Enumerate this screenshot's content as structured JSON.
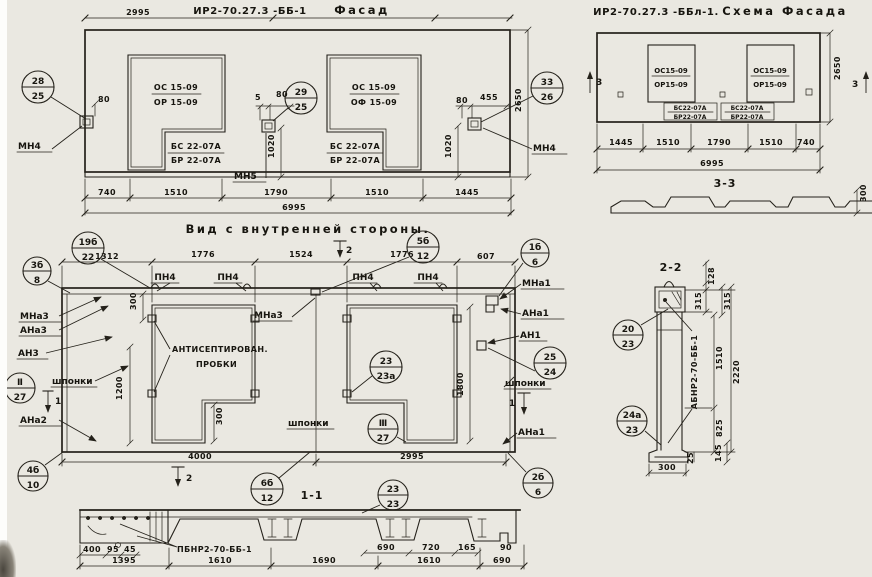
{
  "paper": {
    "bg": "#eae8e1",
    "ink": "#24211a"
  },
  "facade": {
    "dim_2995": "2995",
    "code": "ИР2-70.27.3 -ББ-1",
    "title": "Фасад",
    "win1_top": "ОС 15-09",
    "win1_bot": "ОР 15-09",
    "win2_top": "ОС 15-09",
    "win2_bot": "ОФ 15-09",
    "block1_top": "БС 22-07А",
    "block1_bot": "БР 22-07А",
    "block2_top": "БС 22-07А",
    "block2_bot": "БР 22-07А",
    "mn4_left": "МН4",
    "mn5": "МН5",
    "mn4_right": "МН4",
    "d80_left": "80",
    "d5": "5",
    "d80_mid": "80",
    "d80_right": "80",
    "d455": "455",
    "d1020_left": "1020",
    "d1020_right": "1020",
    "d2650": "2650",
    "dims_bottom": [
      "740",
      "1510",
      "1790",
      "1510",
      "1445"
    ],
    "d6995": "6995",
    "c28": {
      "top": "28",
      "bot": "25"
    },
    "c29": {
      "top": "29",
      "bot": "25"
    },
    "c33": {
      "top": "33",
      "bot": "26"
    }
  },
  "scheme": {
    "code": "ИР2-70.27.3 -ББл-1.",
    "title": "Схема Фасада",
    "win_top": "ОС15-09",
    "win_bot": "ОР15-09",
    "blk_top": "БС22-07А",
    "blk_bot": "БР22-07А",
    "marker3": "3",
    "d2650": "2650",
    "dims_bottom": [
      "1445",
      "1510",
      "1790",
      "1510",
      "740"
    ],
    "d6995": "6995",
    "sec33": "3-3",
    "d300": "300"
  },
  "inner": {
    "title": "Вид с внутренней стороны.",
    "dims_top": [
      "1312",
      "1776",
      "1524",
      "1776",
      "607"
    ],
    "marker2": "2",
    "marker1": "1",
    "pn4": "ПН4",
    "mna3_mid": "МНа3",
    "left": {
      "mna3": "МНа3",
      "ana3": "АНа3",
      "an3": "АН3",
      "ana2": "АНа2"
    },
    "right": {
      "mna1": "МНа1",
      "ana1": "АНа1",
      "an1": "АН1",
      "ana1b": "АНа1"
    },
    "shponki": "шпонки",
    "plugs1": "АНТИСЕПТИРОВАН.",
    "plugs2": "ПРОБКИ",
    "d300_top": "300",
    "d1200": "1200",
    "d300_w1": "300",
    "d1800": "1800",
    "d4000": "4000",
    "d2995": "2995",
    "c19b": {
      "top": "19б",
      "bot": "22"
    },
    "c3b": {
      "top": "3б",
      "bot": "8"
    },
    "c5b": {
      "top": "5б",
      "bot": "12"
    },
    "c1b": {
      "top": "1б",
      "bot": "6"
    },
    "cII": {
      "top": "Ⅱ",
      "bot": "27"
    },
    "cIII": {
      "top": "Ⅲ",
      "bot": "27"
    },
    "c2323a": {
      "top": "23",
      "bot": "23а"
    },
    "c2524": {
      "top": "25",
      "bot": "24"
    },
    "c4b": {
      "top": "4б",
      "bot": "10"
    },
    "c6b": {
      "top": "6б",
      "bot": "12"
    },
    "c2b": {
      "top": "2б",
      "bot": "6"
    }
  },
  "section11": {
    "title": "1-1",
    "label": "ПБНР2-70-ББ-1",
    "c2323": {
      "top": "23",
      "bot": "23"
    },
    "small_left": [
      "400",
      "95",
      "45"
    ],
    "small_right": [
      "690",
      "720",
      "165",
      "90"
    ],
    "dims_bottom": [
      "1395",
      "1610",
      "1690",
      "1610",
      "690"
    ]
  },
  "section22": {
    "title": "2-2",
    "label": "АБНР2-70-ББ-1",
    "c2023": {
      "top": "20",
      "bot": "23"
    },
    "c24a": {
      "top": "24а",
      "bot": "23"
    },
    "d128": "128",
    "d315a": "315",
    "d315b": "315",
    "d1510": "1510",
    "d2220": "2220",
    "d825": "825",
    "d300": "300",
    "d25": "25",
    "d145": "145"
  }
}
